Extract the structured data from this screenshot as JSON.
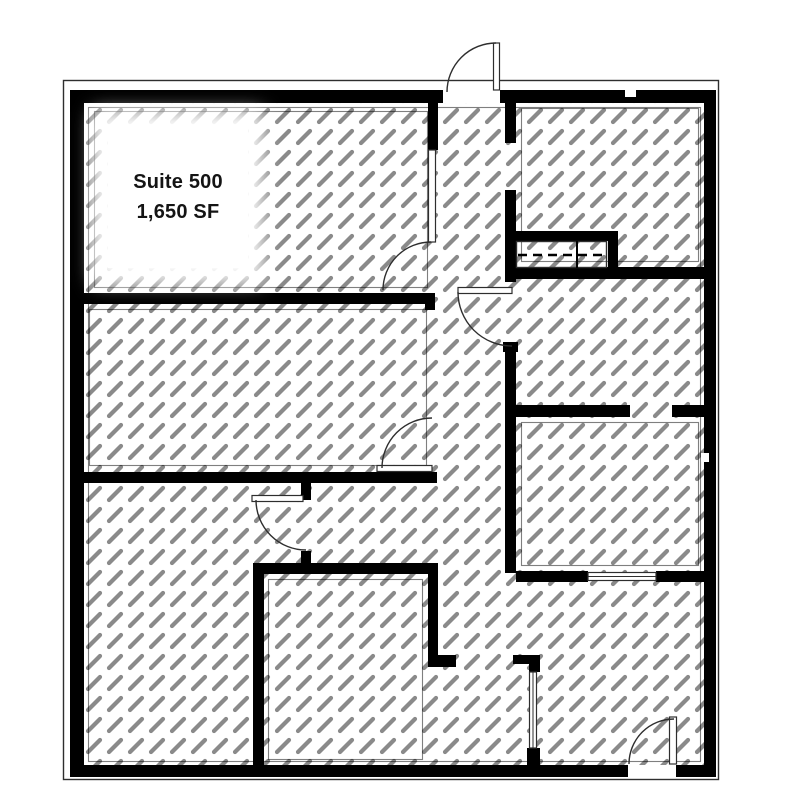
{
  "label": {
    "suite": "Suite 500",
    "area": "1,650 SF"
  },
  "colors": {
    "wall": "#000000",
    "line": "#2e2e2e",
    "hatch": "#8a8a8a",
    "bg": "#ffffff",
    "text": "#141414"
  }
}
